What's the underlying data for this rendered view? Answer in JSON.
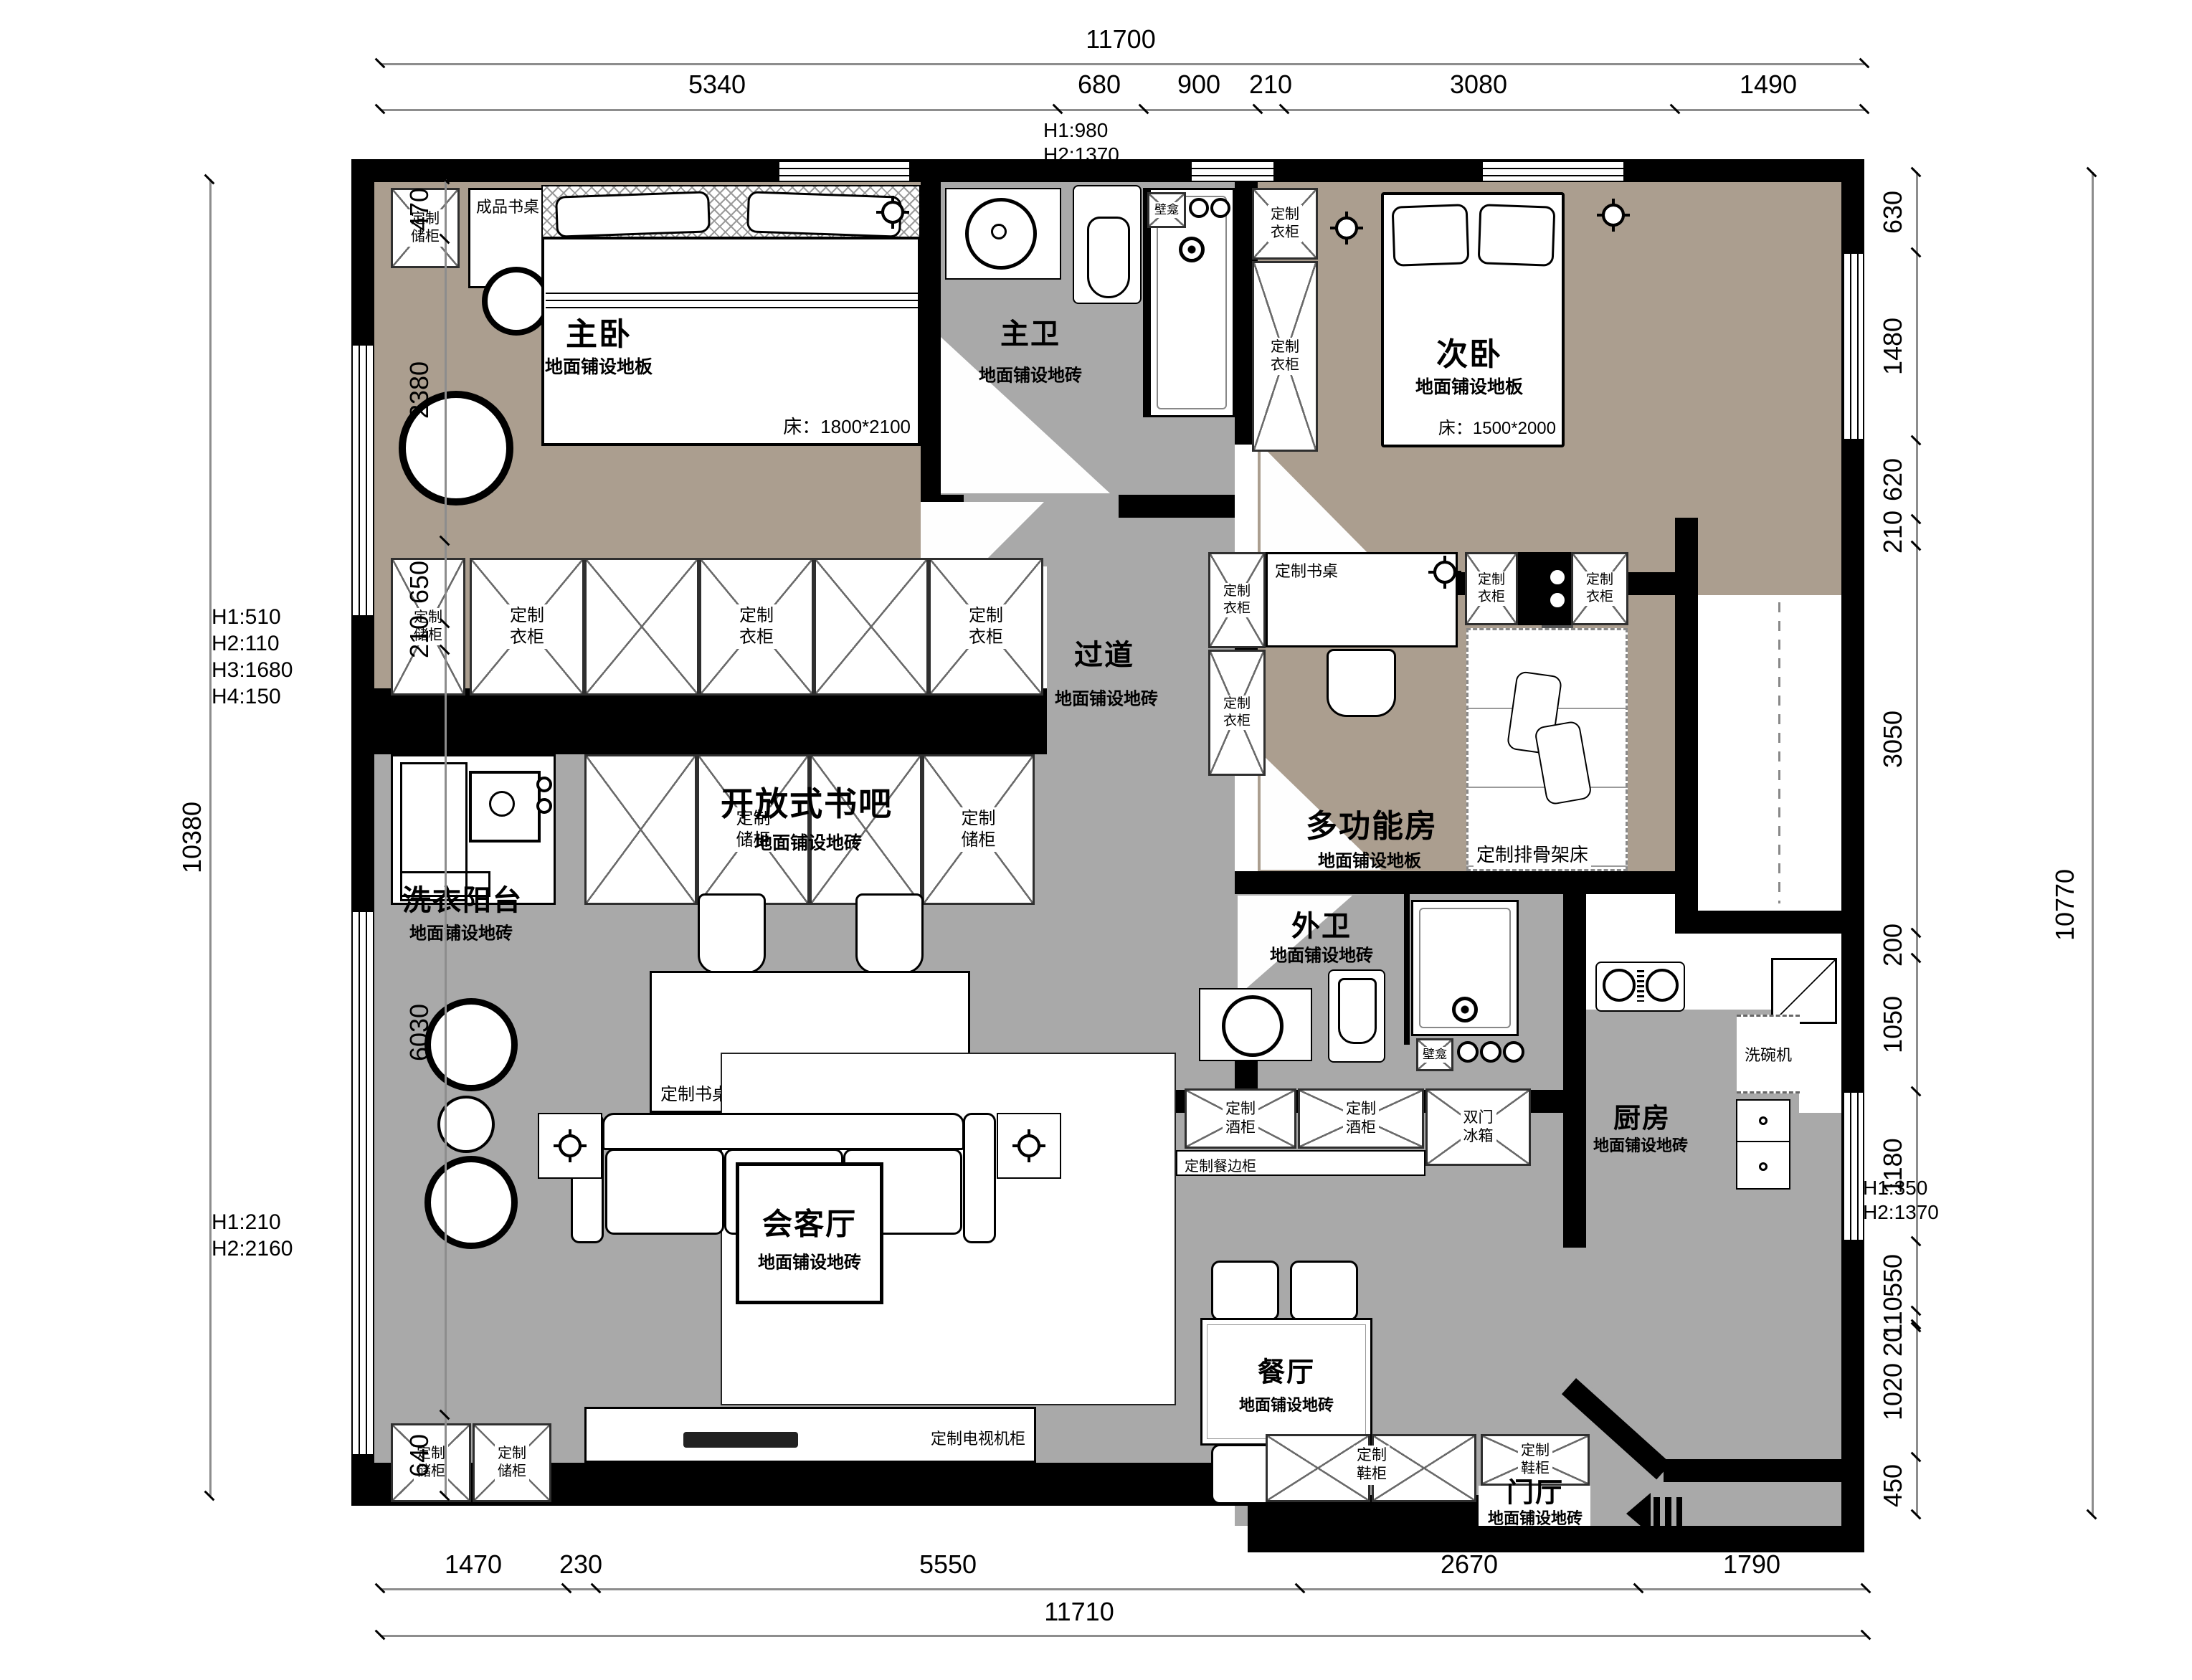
{
  "colors": {
    "wall": "#000000",
    "wood_floor": "#ab9e8f",
    "tile_floor": "#a9a9a9",
    "dim_line": "#8d8d8d"
  },
  "rooms": {
    "master_bedroom": {
      "name": "主卧",
      "floor": "地面铺设地板",
      "bed": "床：1800*2100"
    },
    "master_bath": {
      "name": "主卫",
      "floor": "地面铺设地砖"
    },
    "second_bedroom": {
      "name": "次卧",
      "floor": "地面铺设地板",
      "bed": "床：1500*2000"
    },
    "corridor": {
      "name": "过道",
      "floor": "地面铺设地砖"
    },
    "multi_room": {
      "name": "多功能房",
      "floor": "地面铺设地板"
    },
    "laundry_balcony": {
      "name": "洗衣阳台",
      "floor": "地面铺设地砖"
    },
    "book_bar": {
      "name": "开放式书吧",
      "floor": "地面铺设地砖"
    },
    "guest_bath": {
      "name": "外卫",
      "floor": "地面铺设地砖"
    },
    "living": {
      "name": "会客厅",
      "floor": "地面铺设地砖"
    },
    "dining": {
      "name": "餐厅",
      "floor": "地面铺设地砖"
    },
    "kitchen": {
      "name": "厨房",
      "floor": "地面铺设地砖"
    },
    "foyer": {
      "name": "门厅",
      "floor": "地面铺设地砖"
    }
  },
  "furniture": {
    "custom_storage": "定制\n储柜",
    "custom_wardrobe": "定制\n衣柜",
    "finished_desk": "成品书桌",
    "custom_desk": "定制书桌",
    "custom_slat_bed": "定制排骨架床",
    "niche": "壁龛",
    "dishwasher": "洗碗机",
    "double_door_fridge": "双门\n冰箱",
    "custom_wine_cabinet": "定制\n酒柜",
    "custom_sideboard": "定制餐边柜",
    "custom_tv_cabinet": "定制电视机柜",
    "custom_shoe_cabinet": "定制\n鞋柜"
  },
  "dimensions": {
    "top": {
      "overall": "11700",
      "segments": [
        "5340",
        "680",
        "900",
        "210",
        "3080",
        "1490"
      ],
      "note": "H1:980\nH2:1370"
    },
    "bottom": {
      "overall": "11710",
      "segments": [
        "1470",
        "230",
        "5550",
        "2670",
        "1790"
      ]
    },
    "left": {
      "overall": "10380",
      "segments": [
        "470",
        "2380",
        "650",
        "210",
        "6030",
        "640"
      ],
      "note1": "H1:510\nH2:110\nH3:1680\nH4:150",
      "note2": "H1:210\nH2:2160"
    },
    "right": {
      "overall": "10770",
      "segments": [
        "630",
        "1480",
        "620",
        "210",
        "3050",
        "200",
        "1050",
        "1180",
        "550",
        "110",
        "20",
        "1020",
        "450"
      ],
      "note": "H1:350\nH2:1370"
    }
  }
}
